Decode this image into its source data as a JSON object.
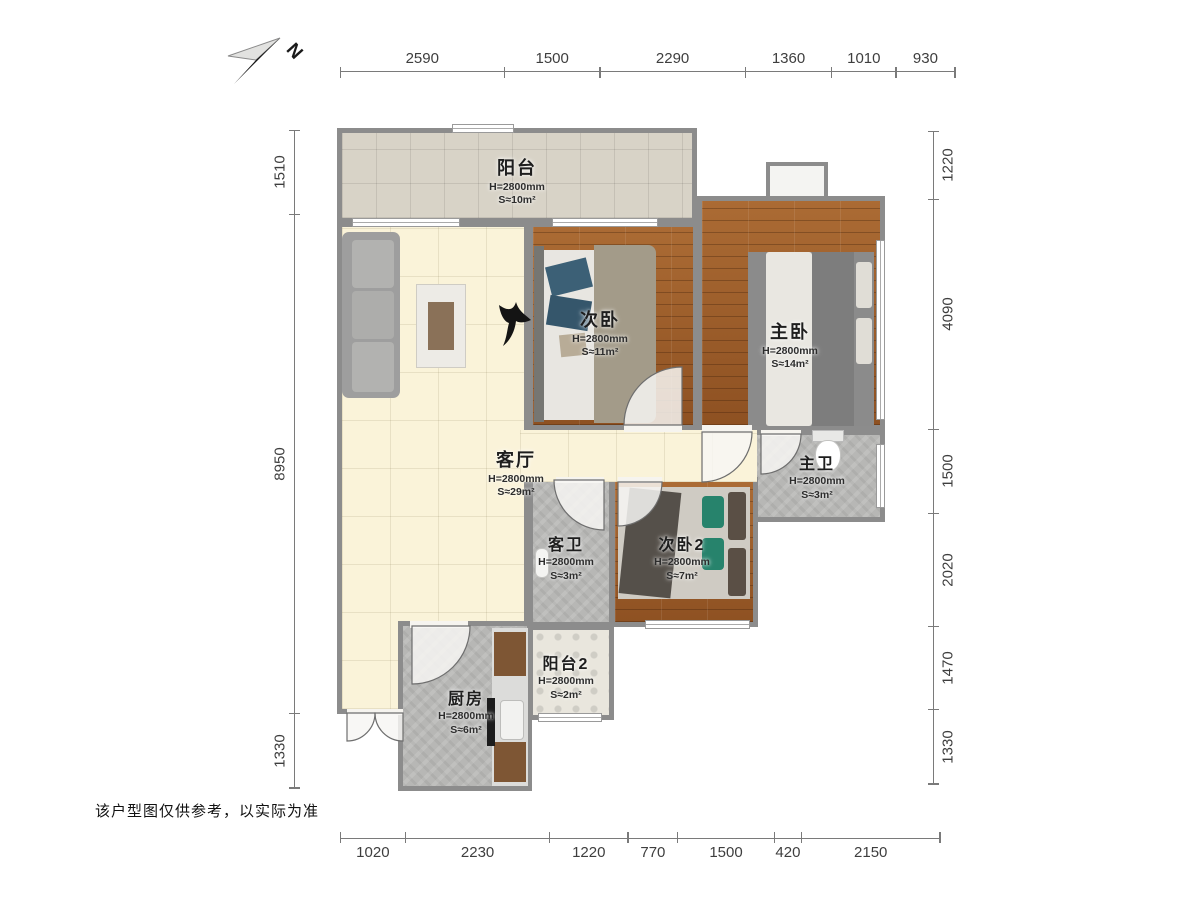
{
  "compass": {
    "label": "N"
  },
  "disclaimer": "该户型图仅供参考，以实际为准",
  "rooms": {
    "balcony": {
      "name": "阳台",
      "height": "H=2800mm",
      "area": "S≈10m²"
    },
    "bedroom2": {
      "name": "次卧",
      "height": "H=2800mm",
      "area": "S≈11m²"
    },
    "master": {
      "name": "主卧",
      "height": "H=2800mm",
      "area": "S≈14m²"
    },
    "living": {
      "name": "客厅",
      "height": "H=2800mm",
      "area": "S≈29m²"
    },
    "master_bath": {
      "name": "主卫",
      "height": "H=2800mm",
      "area": "S≈3m²"
    },
    "guest_bath": {
      "name": "客卫",
      "height": "H=2800mm",
      "area": "S≈3m²"
    },
    "bedroom3": {
      "name": "次卧2",
      "height": "H=2800mm",
      "area": "S≈7m²"
    },
    "balcony2": {
      "name": "阳台2",
      "height": "H=2800mm",
      "area": "S≈2m²"
    },
    "kitchen": {
      "name": "厨房",
      "height": "H=2800mm",
      "area": "S≈6m²"
    }
  },
  "dimensions": {
    "top": [
      2590,
      1500,
      2290,
      1360,
      1010,
      930
    ],
    "bottom": [
      1020,
      2230,
      1220,
      770,
      1500,
      420,
      2150
    ],
    "left": [
      1510,
      8950,
      1330
    ],
    "right": [
      1220,
      4090,
      1500,
      2020,
      1470,
      1330
    ]
  }
}
